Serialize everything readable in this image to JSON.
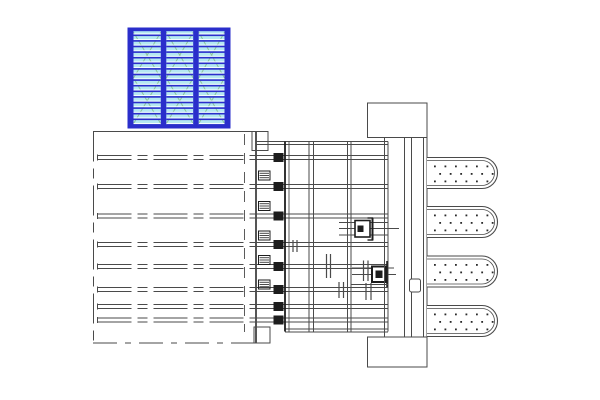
{
  "meta": {
    "drawing_kind": "cad-technical-plan-detail",
    "description": "Plan-view CAD detail: selected blue formwork panel block, excavation zone with anchor beams, retaining wall with clamps, grid cage with connector fittings, guide column and four dotted piles"
  },
  "colors": {
    "background": "#ffffff",
    "line": "#4a4a4a",
    "dark": "#1d1d1d",
    "blue_frame": "#2a2ecb",
    "cyan_fill": "#b5e8f2",
    "stripe_white": "#f4fcff",
    "brace_green": "#8cc49b"
  },
  "panel_block": {
    "x": 128,
    "y": 28,
    "w": 102,
    "h": 100,
    "border_h": 3.2,
    "bar_w": 5.5,
    "bars_x": [
      128,
      160.8,
      193.2,
      224.5
    ],
    "stripe_period": 5.6,
    "stripe_white_h": 1.1,
    "stripe_blue_h": 1.6
  },
  "excavation": {
    "left": 93.5,
    "top": 131.5,
    "right": 256,
    "bottom": 343,
    "top_x2": 268,
    "bottom_x2": 270,
    "edge_dash": "30 7 10 7",
    "bottom_dash": "24 8 6 8",
    "inner_dashed_x": 244.5,
    "inner_dash_y1": 134,
    "inner_dash_y2": 332,
    "inner_dash": "11 8",
    "step_top": {
      "x": 252,
      "y": 131.5,
      "w": 16,
      "h": 19
    },
    "step_bottom": {
      "x": 254,
      "y": 327,
      "w": 16,
      "h": 16
    }
  },
  "beams": {
    "ys": [
      157.5,
      186.5,
      216,
      244.5,
      266.5,
      289.5,
      306.5,
      320
    ],
    "x_start": 97.5,
    "x_mid": 256,
    "x_end": 388,
    "half_gap": 2,
    "dash": "34 6 10 6"
  },
  "wall": {
    "x_main": 285,
    "x_second": 289,
    "y1": 141.5,
    "y2": 331.5,
    "squares": {
      "x": 273.5,
      "w": 10,
      "h": 9
    },
    "clamps": {
      "x": 258.5,
      "w": 11.5,
      "h": 9,
      "ys": [
        171,
        201.5,
        231,
        255.5,
        280
      ]
    }
  },
  "cage": {
    "y1": 141.5,
    "y2": 331.5,
    "v_pairs": [
      [
        309,
        313.5
      ],
      [
        347.5,
        351
      ],
      [
        384.5,
        388
      ]
    ],
    "top_ys": [
      141.5,
      144.5
    ],
    "top_x1": 256,
    "top_x2": 388,
    "bottom_ys": [
      329,
      332
    ],
    "bottom_x1": 285,
    "bottom_x2": 388
  },
  "column": {
    "cap_top": {
      "x": 367.5,
      "y": 103,
      "w": 59.5,
      "h": 34.5
    },
    "cap_bottom": {
      "x": 367.5,
      "y": 337,
      "w": 59.5,
      "h": 30
    },
    "verticals": [
      384.5,
      404.5,
      411.5,
      423.5,
      427
    ],
    "v_y1": 137.5,
    "v_y2": 337,
    "handle": {
      "x": 409.5,
      "y": 279,
      "w": 11,
      "h": 13
    }
  },
  "piles": {
    "x": 427,
    "len": 70.5,
    "h": 31,
    "tops": [
      157.5,
      206.5,
      256,
      305.5
    ],
    "inset": 3,
    "dot_size": 1.8,
    "dot_step": 10.5,
    "dot_rows": [
      8,
      15.5,
      23
    ]
  },
  "details": {
    "bracket1": {
      "hlines": [
        [
          339,
          222.5,
          388
        ],
        [
          339,
          228.5,
          399
        ],
        [
          339,
          235,
          388
        ]
      ],
      "box": [
        355,
        220.5,
        15,
        16.5
      ],
      "inner": [
        357.5,
        225.5,
        6,
        6.5
      ],
      "vline": [
        372.5,
        217.5,
        240.5
      ],
      "stubs": [
        [
          367.5,
          218,
          373
        ],
        [
          367.5,
          240,
          373
        ]
      ]
    },
    "bracket2": {
      "hlines": [
        [
          352,
          268,
          394
        ],
        [
          352,
          274.5,
          396
        ]
      ],
      "box": [
        372,
        266.5,
        14,
        15.5
      ],
      "inner": [
        375.5,
        270.5,
        7,
        7.5
      ],
      "vline": [
        387,
        261,
        288
      ],
      "dbl": [
        [
          350.5,
          284.5,
          388
        ],
        [
          350.5,
          287.5,
          388
        ]
      ]
    },
    "tick_pairs": [
      {
        "xs": [
          326.5,
          330.5
        ],
        "y1": 254,
        "y2": 278
      },
      {
        "xs": [
          363.5,
          368
        ],
        "y1": 260.5,
        "y2": 281
      },
      {
        "xs": [
          366,
          371
        ],
        "y1": 283,
        "y2": 300
      },
      {
        "xs": [
          339,
          343.5
        ],
        "y1": 282,
        "y2": 298
      },
      {
        "xs": [
          293,
          297
        ],
        "y1": 240,
        "y2": 252
      }
    ]
  }
}
